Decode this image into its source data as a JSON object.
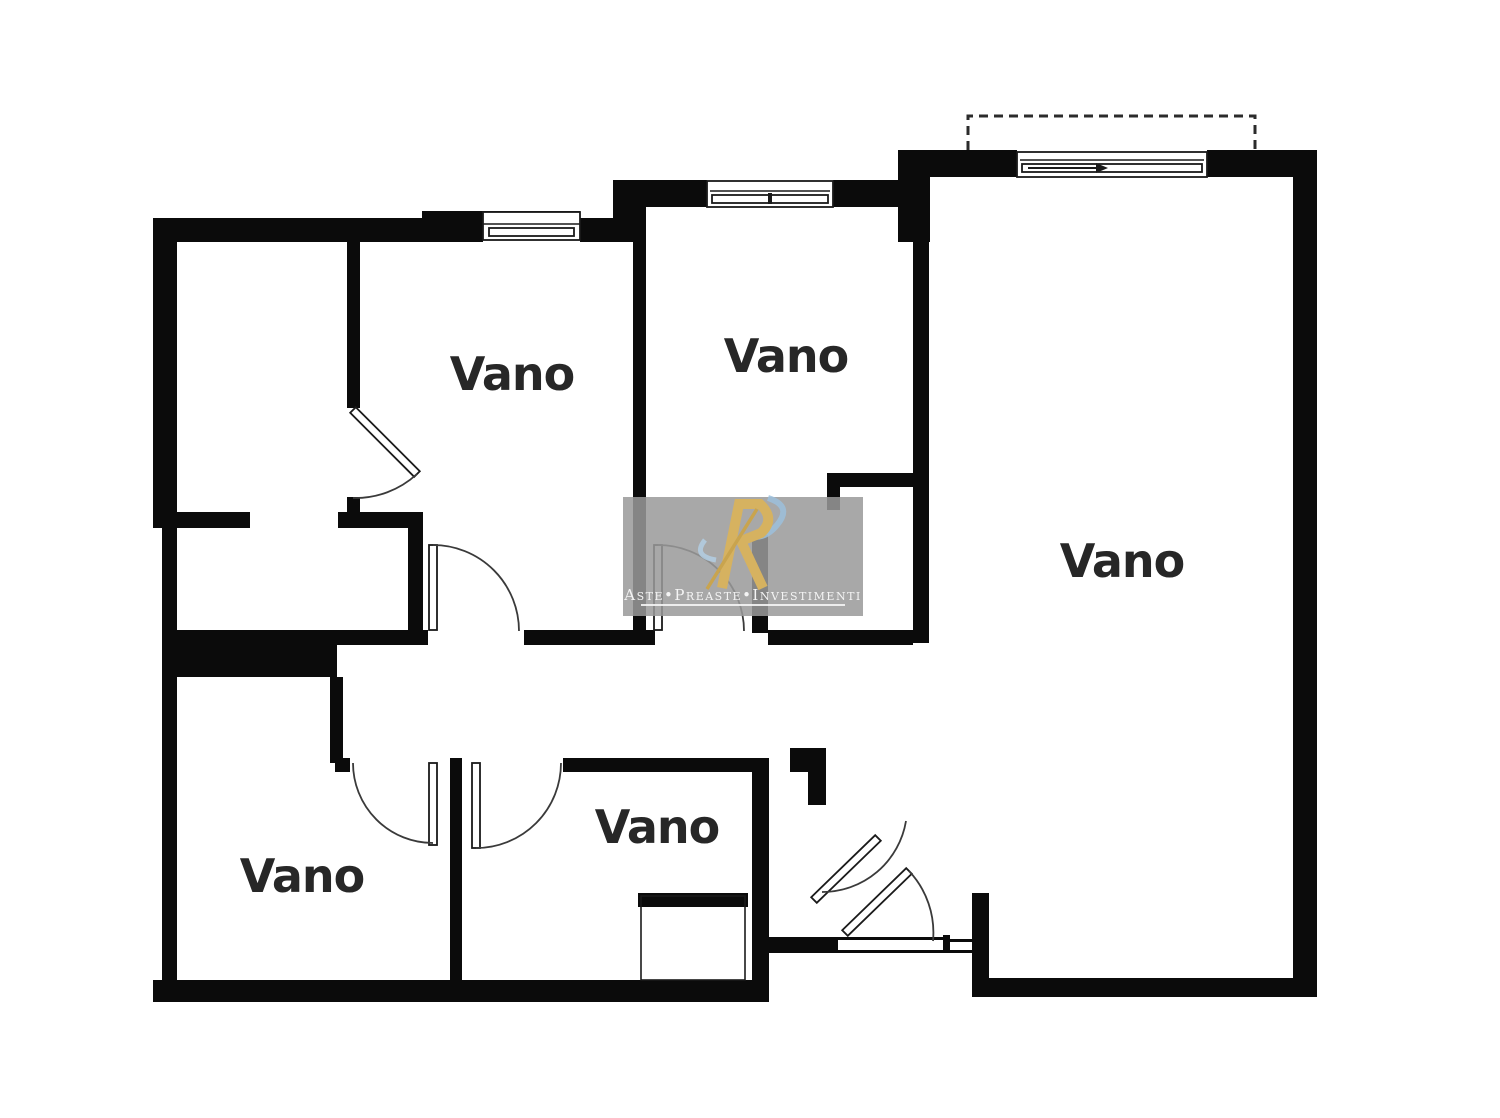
{
  "document": {
    "type": "floor-plan",
    "language": "it"
  },
  "rooms": [
    {
      "label": "Vano"
    },
    {
      "label": "Vano"
    },
    {
      "label": "Vano"
    },
    {
      "label": "Vano"
    },
    {
      "label": "Vano"
    }
  ],
  "watermark": {
    "brand": "Aste•Preaste•Investimenti"
  },
  "colors": {
    "background": "#ffffff",
    "wall": "#0b0b0b",
    "door_arc": "#3a3a3a",
    "room_label": "#272727",
    "watermark_panel": "#9a9a9a",
    "watermark_gold": "#d6b260",
    "watermark_gold_dark": "#c9a44e",
    "watermark_blue": "#9cc0dc",
    "watermark_blue_light": "#b3d0e6",
    "watermark_text": "#f4f4f4"
  }
}
